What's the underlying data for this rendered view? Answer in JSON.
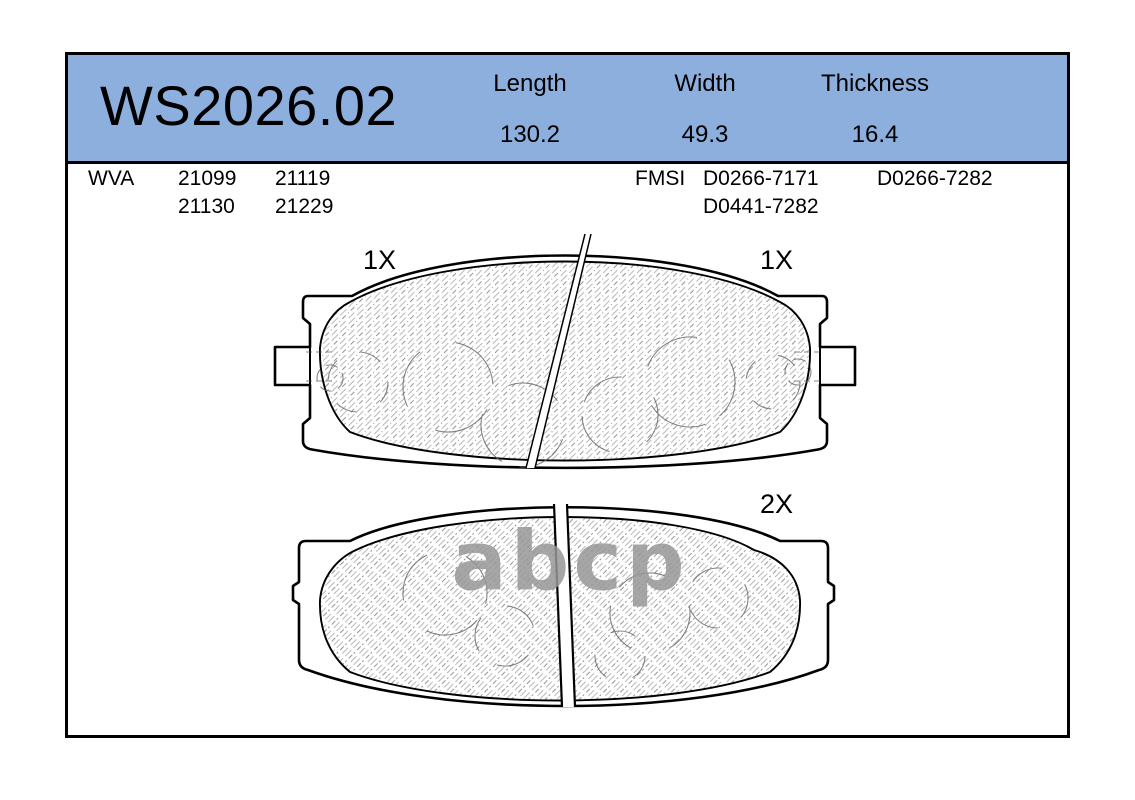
{
  "card": {
    "part_number": "WS2026.02",
    "dimensions": [
      {
        "label": "Length",
        "value": "130.2"
      },
      {
        "label": "Width",
        "value": "49.3"
      },
      {
        "label": "Thickness",
        "value": "16.4"
      }
    ],
    "references": {
      "wva": {
        "label": "WVA",
        "numbers": [
          "21099",
          "21119",
          "21130",
          "21229"
        ]
      },
      "fmsi": {
        "label": "FMSI",
        "numbers": [
          "D0266-7171",
          "D0266-7282",
          "D0441-7282"
        ]
      }
    },
    "drawings": {
      "top_pad": {
        "left_quantity": "1X",
        "right_quantity": "1X"
      },
      "bottom_pad": {
        "quantity": "2X"
      }
    },
    "watermark": "abcp",
    "colors": {
      "header_background": "#8DAFDE",
      "border": "#000000",
      "outline": "#000000",
      "hatch_line": "#8a8a8a",
      "watermark_gray": "#969696"
    }
  }
}
